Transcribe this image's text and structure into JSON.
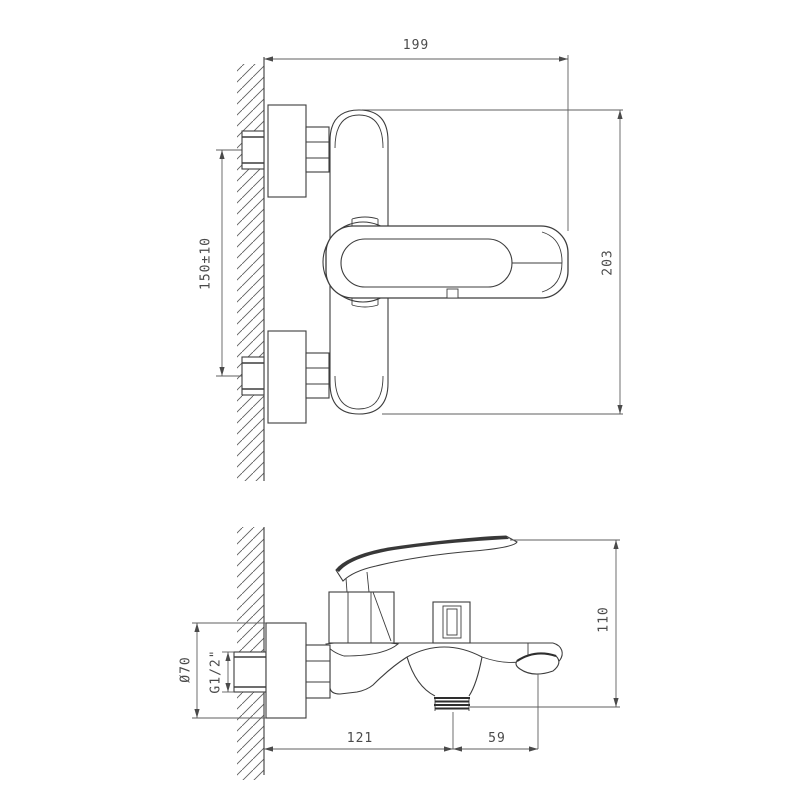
{
  "drawing": {
    "type": "technical-dimension-drawing",
    "subject": "wall-mounted bathtub mixer faucet, front view (top) and side view (bottom)",
    "units": "mm",
    "colors": {
      "background": "#ffffff",
      "object_line": "#3d3d3d",
      "dimension_line": "#5f5f5f",
      "text": "#4a4a4a"
    }
  },
  "front_view": {
    "width_label": "199",
    "height_label": "203",
    "mounting_distance_label": "150±10"
  },
  "side_view": {
    "height_label": "110",
    "wall_to_shower_outlet_label": "121",
    "outlet_to_spout_label": "59",
    "flange_diameter_label": "Ø70",
    "thread_label": "G1/2\""
  }
}
